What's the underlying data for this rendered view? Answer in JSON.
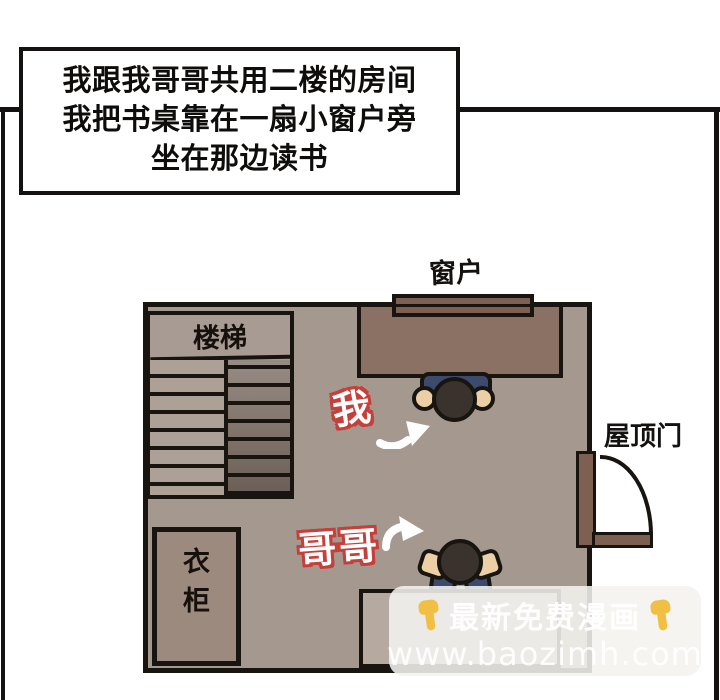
{
  "caption": {
    "lines": [
      "我跟我哥哥共用二楼的房间",
      "我把书桌靠在一扇小窗户旁",
      "坐在那边读书"
    ]
  },
  "floorplan": {
    "window_label": "窗户",
    "stairs_label": "楼梯",
    "me_label": "我",
    "brother_label": "哥哥",
    "roof_door_label": "屋顶门",
    "wardrobe_chars": [
      "衣",
      "柜"
    ]
  },
  "watermark": {
    "line1": "最新免费漫画",
    "line2": "www.baozimh.com"
  },
  "icons": {
    "finger": "point-down-finger",
    "me_arrow": "curved-arrow-up-right",
    "brother_arrow": "curved-arrow-up-right",
    "door_arc": "door-swing-arc"
  },
  "colors": {
    "panel_border": "#141210",
    "room_floor": "#a5988f",
    "desk_brown": "#8b7164",
    "window_brown": "#7d6051",
    "wardrobe_brown": "#9d8a7f",
    "stairs_dark": "#6b5e56",
    "figure_navy": "#3c4a6d",
    "figure_skin": "#eccfa5",
    "figure_head": "#3a332d",
    "label_outline_red": "#c5403a",
    "watermark_bg": "#f4f2ef",
    "watermark_text": "#ffffff",
    "emoji_yellow": "#f2bf45"
  }
}
